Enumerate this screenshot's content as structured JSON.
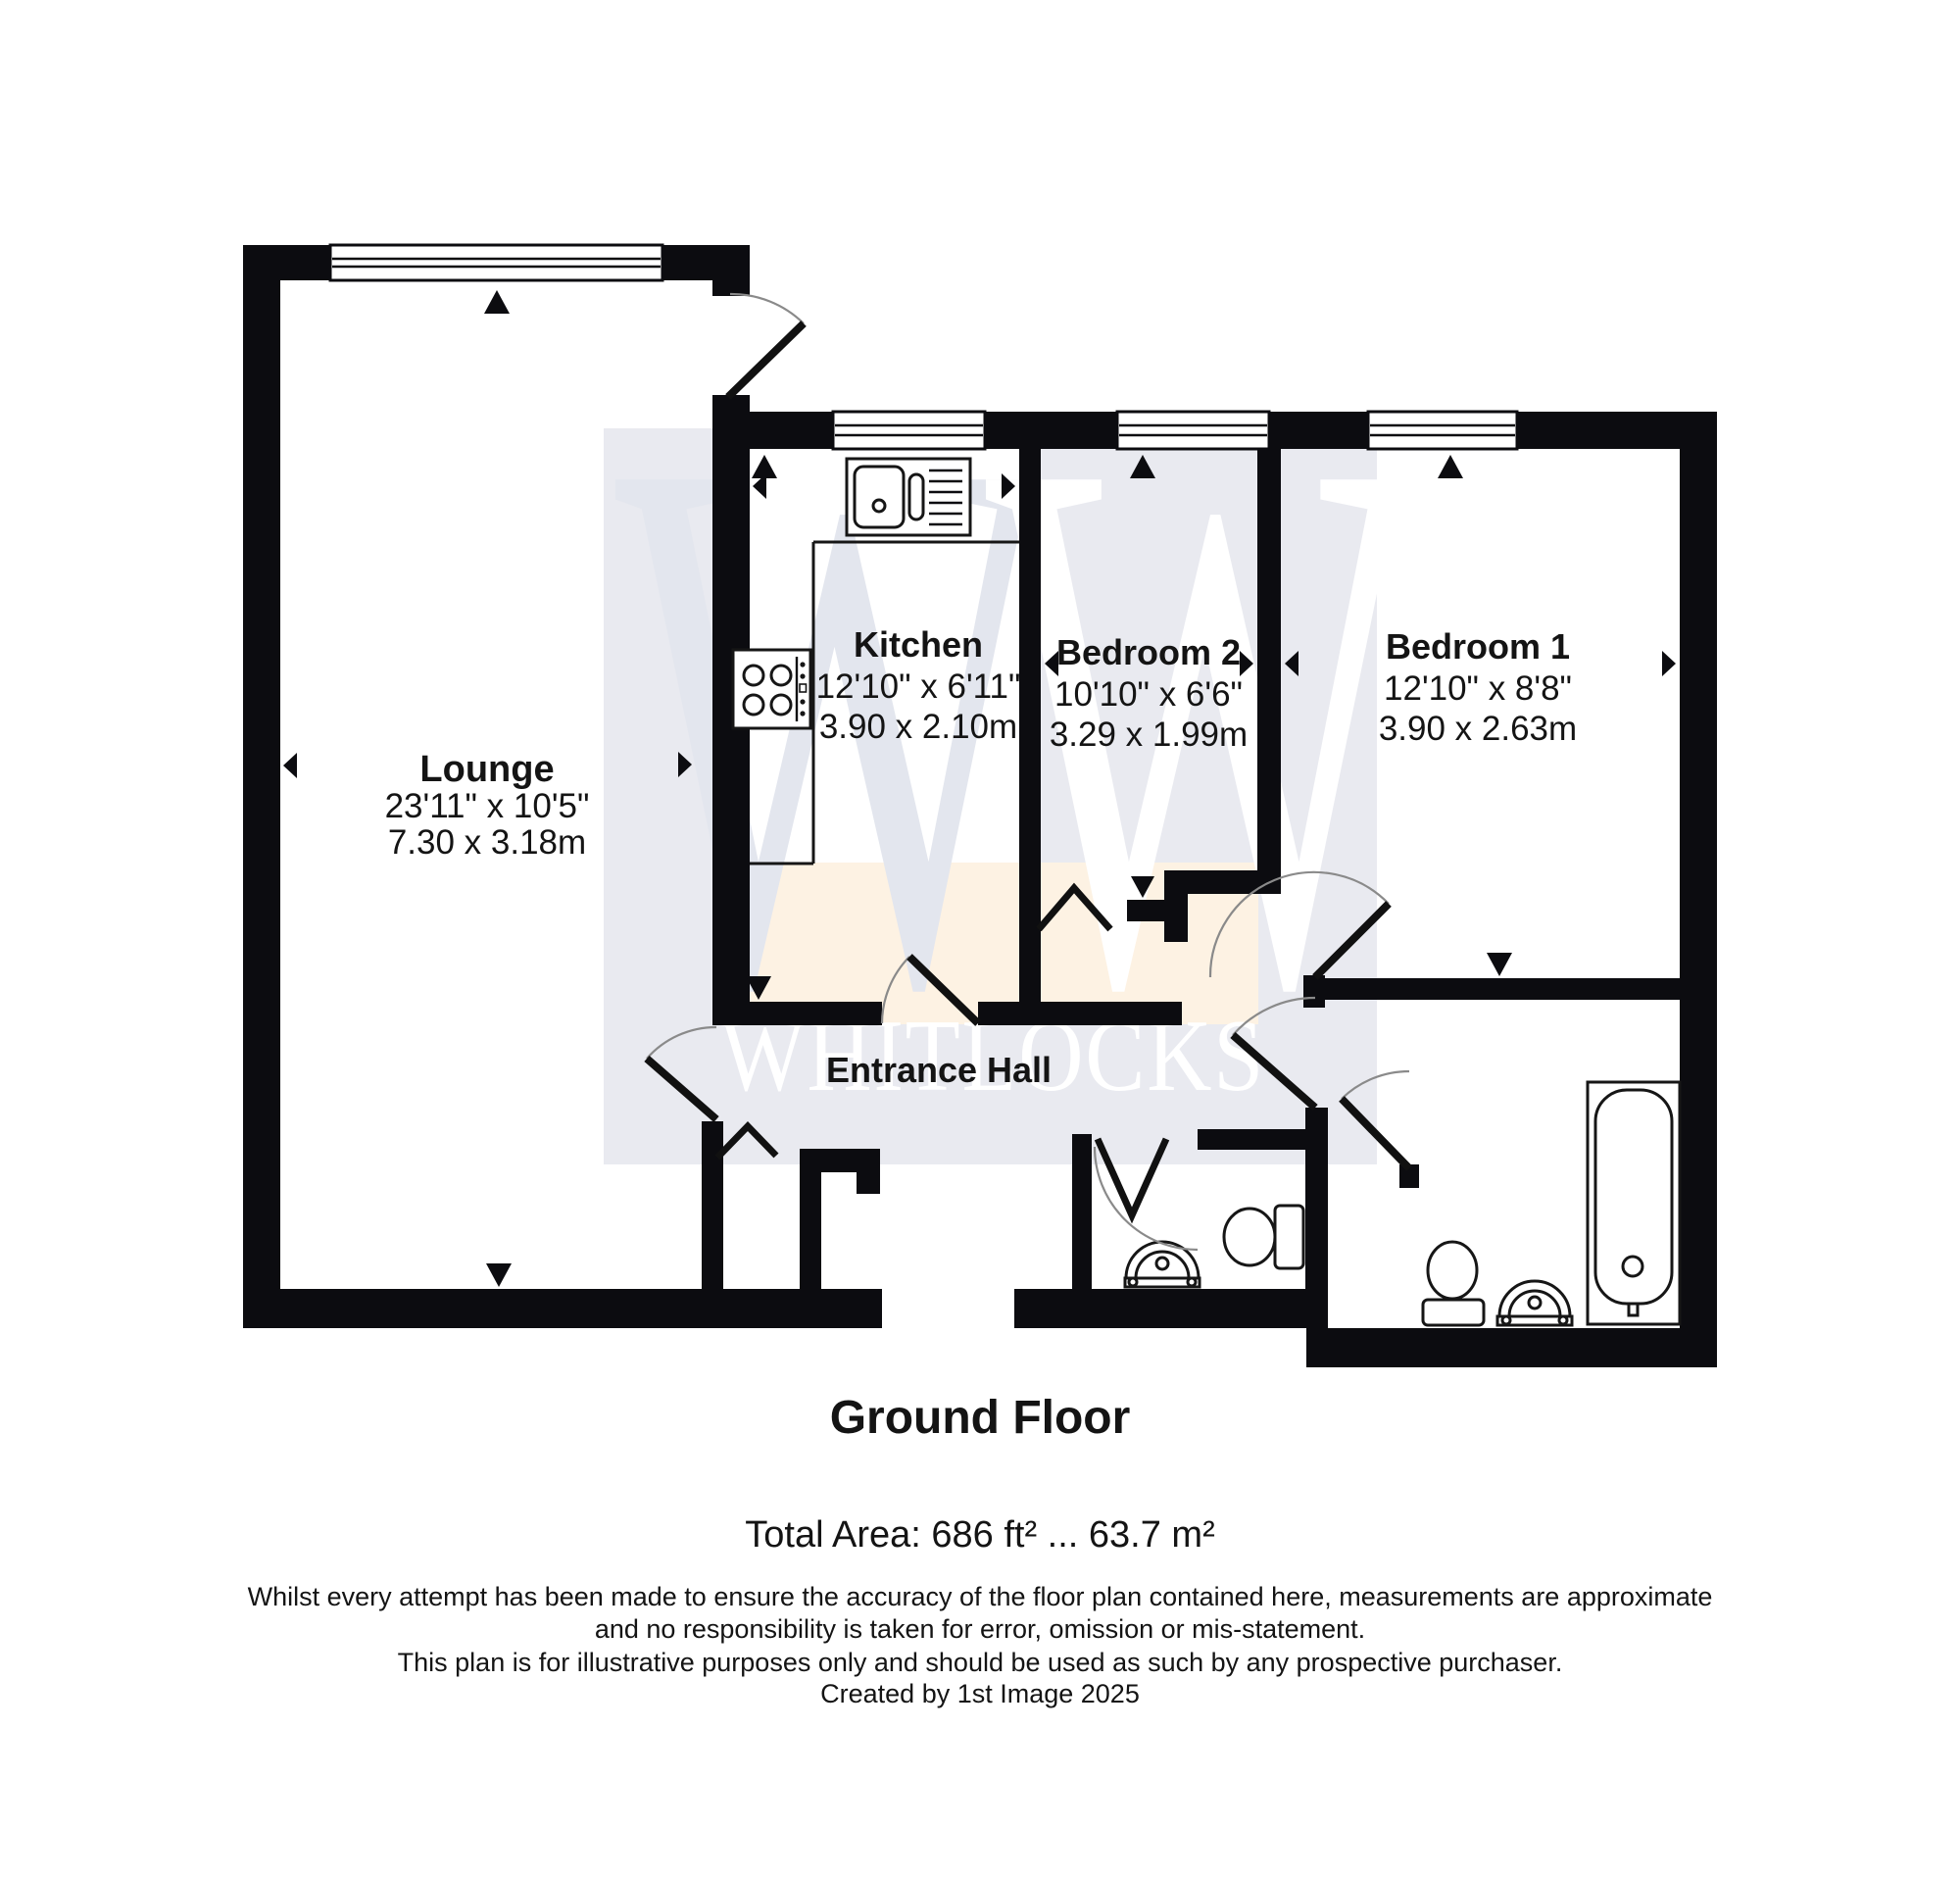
{
  "watermark": {
    "brand": "WHITLOCKS",
    "monogram": "W",
    "colors": {
      "gray": "#e9eaf0",
      "cream": "#fdf2e3",
      "monogram_gray": "#e3e6ee"
    }
  },
  "rooms": {
    "lounge": {
      "name": "Lounge",
      "size_imperial": "23'11\" x 10'5\"",
      "size_metric": "7.30 x 3.18m"
    },
    "kitchen": {
      "name": "Kitchen",
      "size_imperial": "12'10\" x 6'11\"",
      "size_metric": "3.90 x 2.10m"
    },
    "bedroom2": {
      "name": "Bedroom 2",
      "size_imperial": "10'10\" x 6'6\"",
      "size_metric": "3.29 x 1.99m"
    },
    "bedroom1": {
      "name": "Bedroom 1",
      "size_imperial": "12'10\" x 8'8\"",
      "size_metric": "3.90 x 2.63m"
    },
    "hall": {
      "name": "Entrance Hall"
    }
  },
  "footer": {
    "floor_label": "Ground Floor",
    "total_area": "Total Area: 686 ft² ... 63.7 m²",
    "disclaimer_line1": "Whilst every attempt has been made to ensure the accuracy of the floor plan contained here, measurements are approximate",
    "disclaimer_line2": "and no responsibility is taken for error, omission or mis-statement.",
    "disclaimer_line3": "This plan is for illustrative purposes only and should be used as such by any prospective purchaser.",
    "disclaimer_line4": "Created by 1st Image 2025"
  },
  "colors": {
    "wall": "#0c0c10"
  }
}
